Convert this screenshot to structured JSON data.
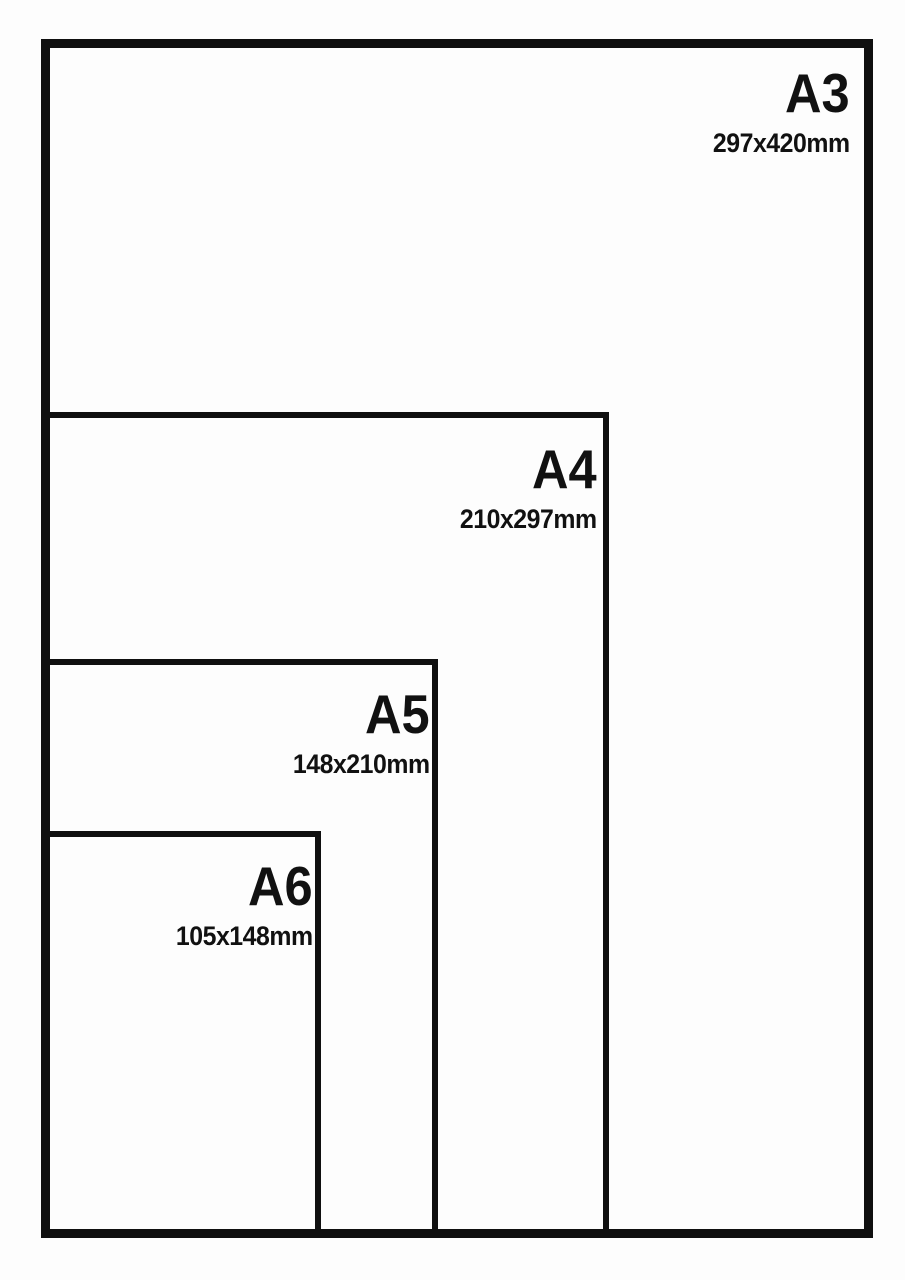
{
  "sheets": [
    {
      "name": "A3",
      "dimensions": "297x420mm"
    },
    {
      "name": "A4",
      "dimensions": "210x297mm"
    },
    {
      "name": "A5",
      "dimensions": "148x210mm"
    },
    {
      "name": "A6",
      "dimensions": "105x148mm"
    }
  ],
  "colors": {
    "line": "#101010",
    "background": "#fdfdfd",
    "text": "#111111"
  }
}
